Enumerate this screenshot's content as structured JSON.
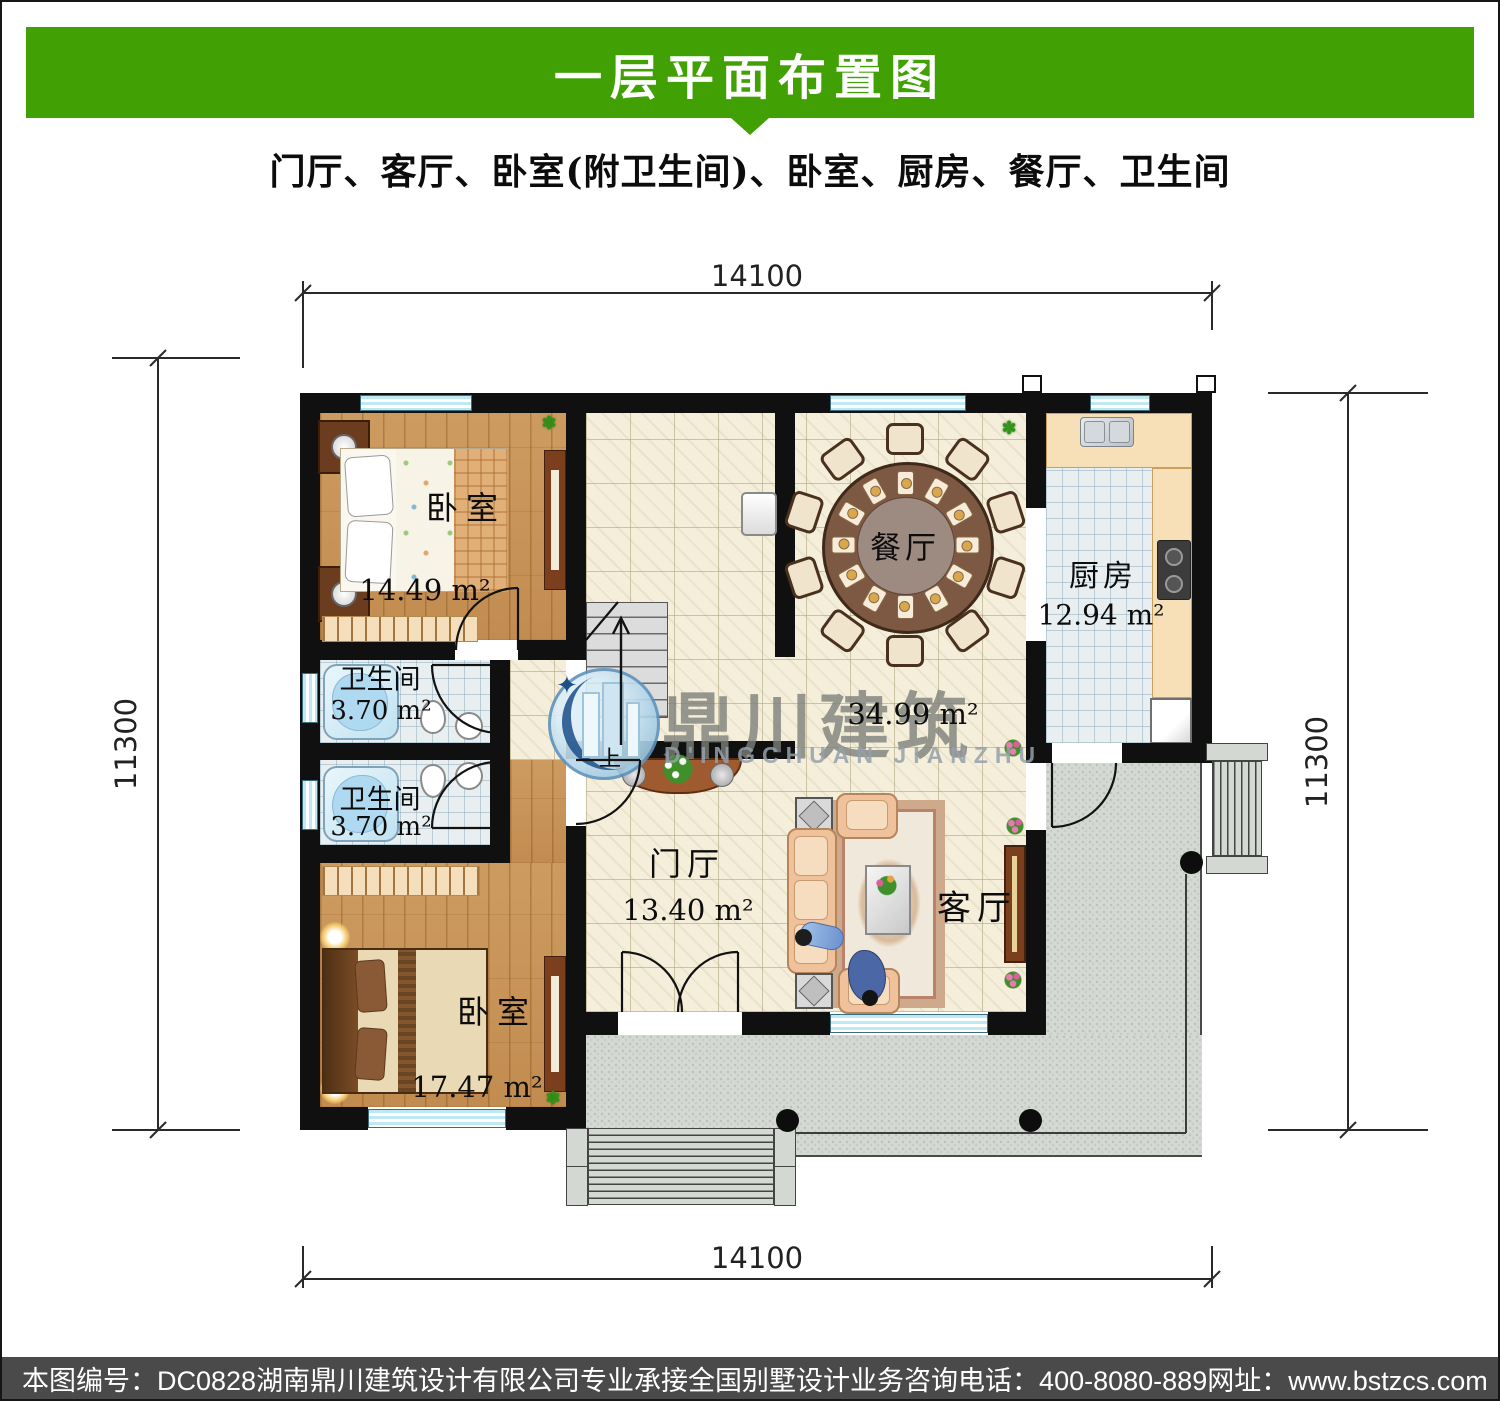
{
  "header": {
    "title": "一层平面布置图",
    "accent_green": "#41a003"
  },
  "subtitle": "门厅、客厅、卧室(附卫生间)、卧室、厨房、餐厅、卫生间",
  "dimensions": {
    "top": "14100",
    "bottom": "14100",
    "left": "11300",
    "right": "11300"
  },
  "rooms": {
    "bedroom1": {
      "name": "卧室",
      "area": "14.49 m²"
    },
    "bedroom2": {
      "name": "卧室",
      "area": "17.47 m²"
    },
    "bath1": {
      "name": "卫生间",
      "area": "3.70 m²"
    },
    "bath2": {
      "name": "卫生间",
      "area": "3.70 m²"
    },
    "kitchen": {
      "name": "厨房",
      "area": "12.94 m²"
    },
    "dining": {
      "name": "餐厅"
    },
    "hall": {
      "name": "门厅",
      "area": "13.40 m²"
    },
    "living": {
      "name": "客厅",
      "area": "34.99 m²"
    }
  },
  "stairs": {
    "up_label": "上"
  },
  "watermark": {
    "cn": "鼎川建筑",
    "en": "D'INGCHUAN JIANZHU"
  },
  "footer": {
    "sheet_no": "本图编号：DC0828",
    "company": "湖南鼎川建筑设计有限公司专业承接全国别墅设计业务",
    "phone": "咨询电话：400-8080-889",
    "website": "网址：www.bstzcs.com"
  },
  "colors": {
    "header_green": "#41a003",
    "footer_gray": "#4a4a4a",
    "wall_black": "#101010",
    "window_cyan": "#bfe9f2"
  }
}
